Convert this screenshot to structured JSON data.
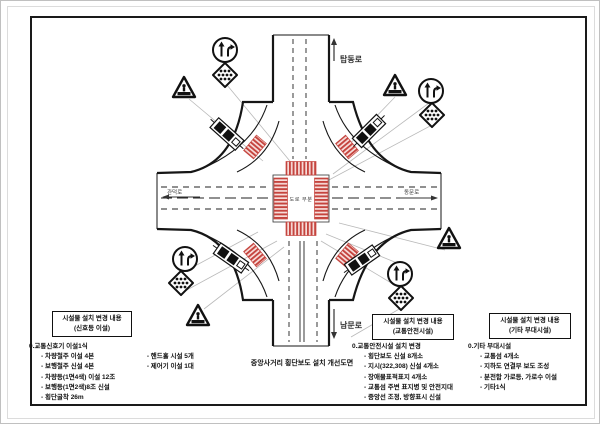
{
  "document": {
    "center_title": "중앙사거리 횡단보도 설치 개선도면",
    "junction_label": "도로 부분"
  },
  "roads": {
    "north": "탑동로",
    "east": "동문로",
    "south": "남문로",
    "west": "관덕로"
  },
  "legend_boxes": [
    {
      "title": "시설물 설치 변경 내용",
      "subtitle": "(신호등 이설)"
    },
    {
      "title": "시설물 설치 변경 내용",
      "subtitle": "(교통안전시설)"
    },
    {
      "title": "시설물 설치 변경 내용",
      "subtitle": "(기타 부대시설)"
    }
  ],
  "notes_signal": {
    "heading": "0.교통신호기 이설1식",
    "row1a": "- 차량철주 이설 4본",
    "row1b": "- 핸드홀 시설 5개",
    "row2a": "- 보행철주 신설 4본",
    "row2b": "- 제어기 이설 1대",
    "row3": "- 차량등(1면4색) 이설 12조",
    "row4": "- 보행등(1면2색)8조 신설",
    "row5": "- 횡단굴착 26m"
  },
  "notes_safety": {
    "heading": "0.교통안전시설 설치 변경",
    "row1": "- 횡단보도 신설 8개소",
    "row2": "- 지시(322,308) 신설 4개소",
    "row3": "- 장애물표적표지 4개소",
    "row4": "- 교통섬 주변 표지병 및 안전지대",
    "row5": "- 중앙선 조정, 방향표시 신설"
  },
  "notes_misc": {
    "heading": "0.기타 부대시설",
    "row1": "- 교통섬 4개소",
    "row2": "- 지하도 연결부 보도 조성",
    "row3": "- 분전함 가로등, 가로수 이설",
    "row4": "- 기타1식"
  },
  "icons": {
    "triangle": "crosswalk-warning-sign",
    "circle": "lane-direction-sign",
    "diamond": "crosswalk-ahead-sign",
    "signal": "traffic-signal-head"
  },
  "colors": {
    "crosswalk_stripe": "#c5443e",
    "crosswalk_fill": "#f7ddda",
    "line_black": "#161616",
    "leader_gray": "#b9b9b9"
  }
}
